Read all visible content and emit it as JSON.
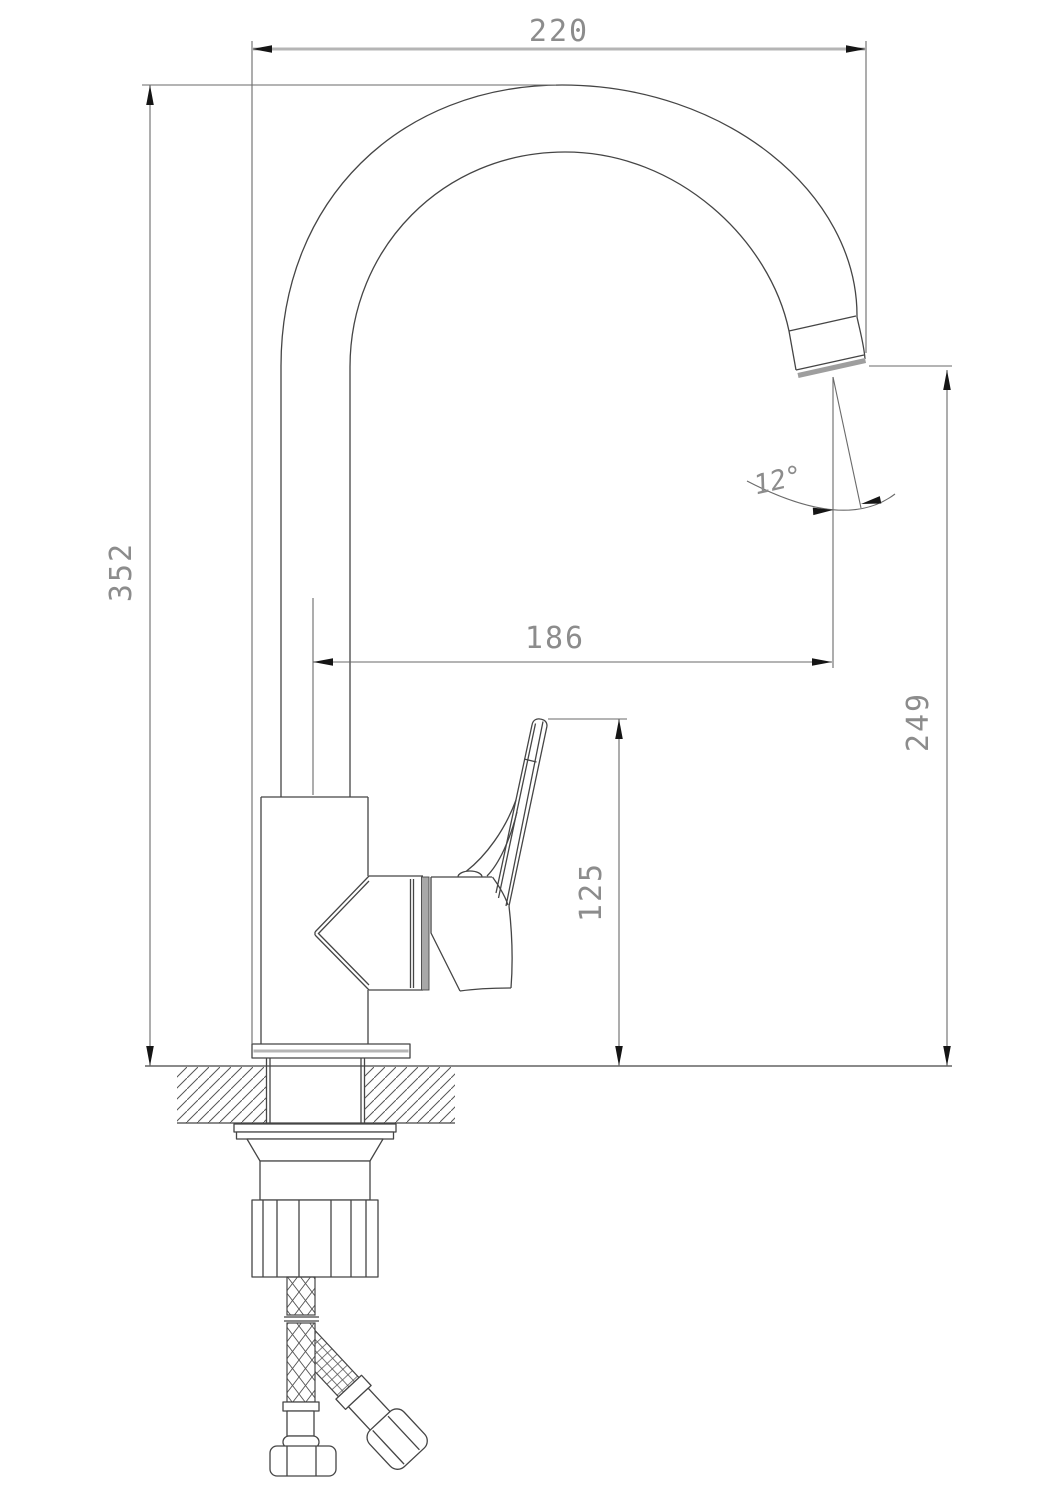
{
  "drawing": {
    "type": "technical-dimension-drawing",
    "subject": "single-lever kitchen faucet, side elevation with mounting hardware and supply hoses",
    "background_color": "#ffffff",
    "line_color": "#454545",
    "dimension_line_color": "#6a6a6a",
    "thick_line_color": "#b5b5b5",
    "text_color": "#8c8c8c",
    "dimensions": {
      "overall_width": "220",
      "overall_height": "352",
      "spout_reach": "186",
      "spout_outlet_height": "249",
      "body_handle_height": "125",
      "outlet_angle": "12°"
    }
  }
}
